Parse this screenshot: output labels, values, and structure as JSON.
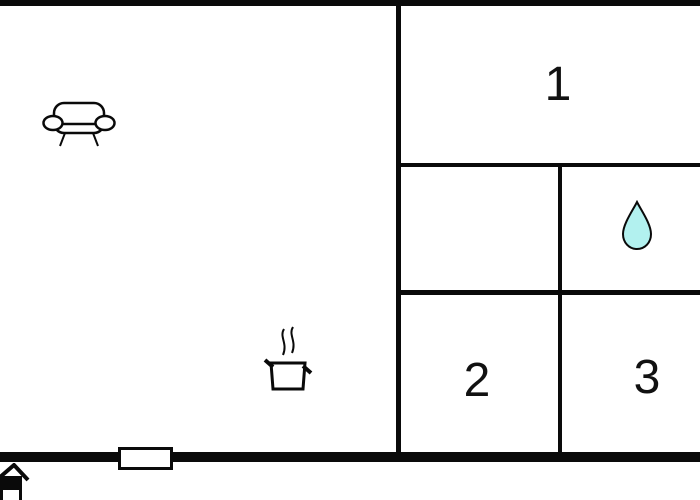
{
  "rooms": [
    {
      "label": "1"
    },
    {
      "label": "2"
    },
    {
      "label": "3"
    }
  ],
  "icons": [
    {
      "name": "sofa-icon"
    },
    {
      "name": "cooking-pot-icon"
    },
    {
      "name": "water-drop-icon"
    },
    {
      "name": "window-marker"
    },
    {
      "name": "house-entrance-icon"
    }
  ],
  "colors": {
    "wall": "#0a0a0a",
    "background": "#ffffff",
    "water_drop_fill": "#b2f1ef",
    "label_color": "#111111"
  }
}
